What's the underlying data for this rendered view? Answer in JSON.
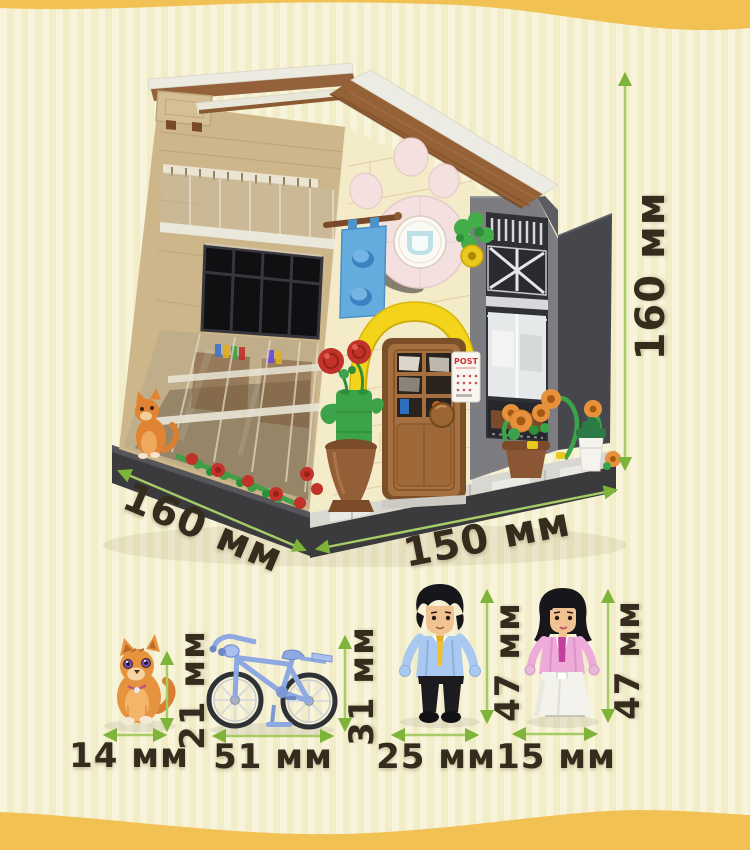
{
  "measurements": {
    "building": {
      "height": "160 мм",
      "depth": "160 мм",
      "width": "150 мм"
    },
    "items": [
      {
        "name": "cat",
        "width": "14 мм",
        "height": "21 мм"
      },
      {
        "name": "bicycle",
        "width": "51 мм",
        "height": "31 мм"
      },
      {
        "name": "man minifigure",
        "width": "25 мм",
        "height": "47 мм"
      },
      {
        "name": "woman minifigure",
        "width": "15 мм",
        "height": "47 мм"
      }
    ]
  },
  "annotations": {
    "post_label": "POST"
  },
  "style": {
    "arrow_head_color": "#7fb43a",
    "arrow_line_color": "#a6cc66",
    "label_color": "#352c1e",
    "wave_color": "#f2c153",
    "background": "#f6f1d3"
  }
}
